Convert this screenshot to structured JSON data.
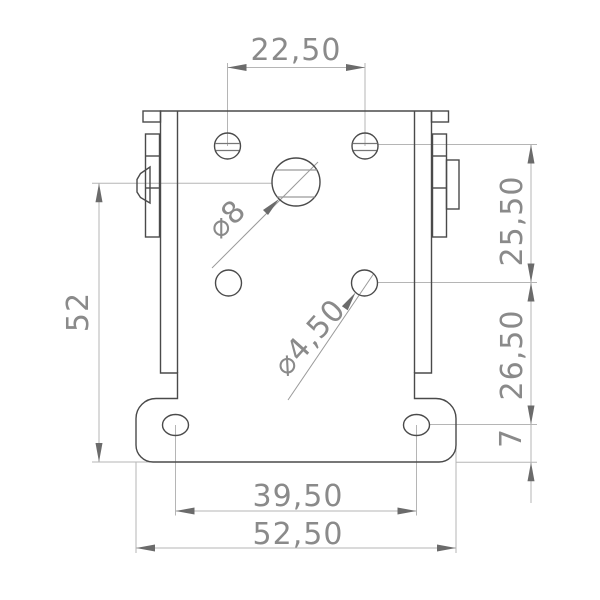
{
  "drawing": {
    "type": "technical-drawing",
    "view": "bracket-front-view",
    "background": "#ffffff",
    "colors": {
      "part_outline": "#4a4a4a",
      "dimension_lines": "#b5b5b5",
      "arrowheads": "#6b6b6b",
      "dimension_text": "#8a8a8a"
    },
    "dimensions": {
      "top_hole_spacing": "22,50",
      "left_overall_height": "52",
      "right_upper_spacing": "25,50",
      "right_lower_spacing": "26,50",
      "right_foot_offset": "7",
      "bottom_hole_spacing": "39,50",
      "bottom_overall_width": "52,50",
      "large_hole_diameter": "⌀8",
      "small_hole_diameter": "⌀4,50"
    }
  }
}
